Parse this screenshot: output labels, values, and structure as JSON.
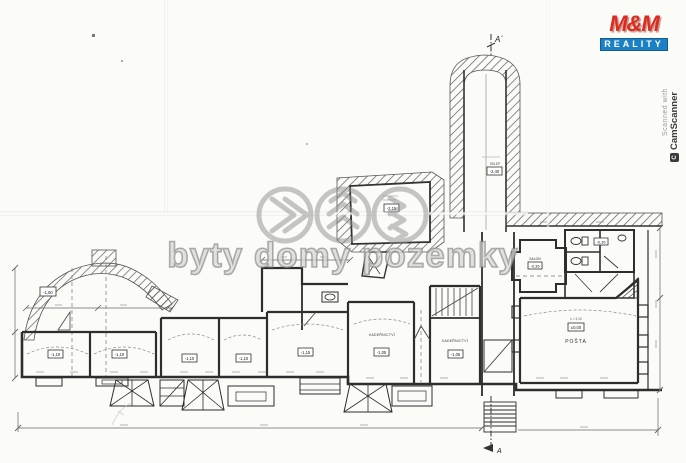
{
  "watermark": {
    "text": "byty domy pozemky"
  },
  "brand": {
    "name": "M&M",
    "tagline": "REALITY"
  },
  "scanner": {
    "prefix": "Scanned with",
    "app": "CamScanner",
    "badge": "C"
  },
  "plan": {
    "section_top": "A´",
    "section_bottom": "A",
    "rooms": {
      "sklep": "SKLEP",
      "kadernictvi_1": "KADEŘNICTVÍ",
      "kadernictvi_2": "KADEŘNICTVÍ",
      "salon": "SALON",
      "posta": "POŠTA",
      "posta_height": "v = 3,10"
    },
    "levels": {
      "left_wing": "-1,60",
      "room_1": "-1,10",
      "room_2": "-1,10",
      "room_3": "-1,10",
      "room_4": "-1,10",
      "room_5": "-1,15",
      "kadernictvi_1": "-1,05",
      "kadernictvi_2": "-1,05",
      "salon": "-0,35",
      "posta": "±0,00",
      "cellar": "-2,15",
      "sklep_corridor": "-2,40",
      "wc": "-0,35"
    }
  }
}
